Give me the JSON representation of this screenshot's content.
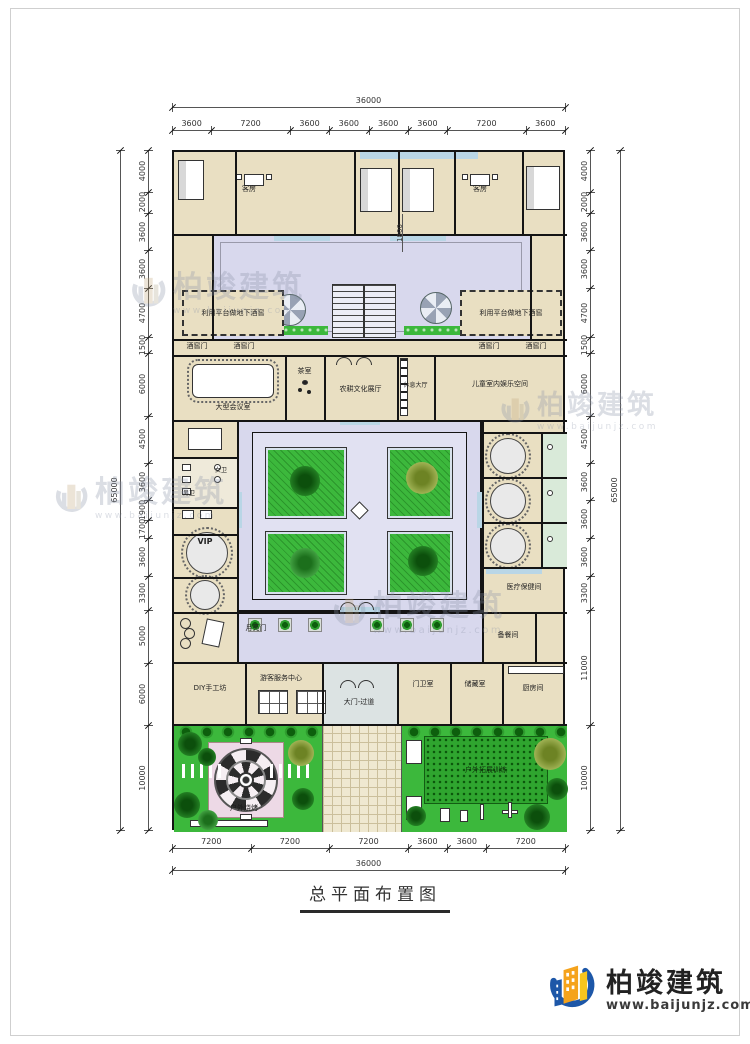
{
  "title": {
    "text": "总平面布置图"
  },
  "logo": {
    "name": "柏竣建筑",
    "url": "www.baijunjz.com"
  },
  "watermark": {
    "text": "柏竣建筑",
    "url": "www.baijunjz.com"
  },
  "colors": {
    "wall": "#141414",
    "room_fill": "#e9dfc2",
    "courtyard": "#d8d8ed",
    "courtyard_inner": "#e1e1f2",
    "green": "#3cb83c",
    "accent_blue": "#b9d6e6",
    "logo_blue": "#1d57a8",
    "logo_orange": "#f5a31c",
    "logo_yellow": "#f7c51d"
  },
  "dims": {
    "top": {
      "total": "36000",
      "segments": [
        "3600",
        "7200",
        "3600",
        "3600",
        "3600",
        "3600",
        "7200",
        "3600"
      ]
    },
    "bottom": {
      "total": "36000",
      "segments": [
        "7200",
        "7200",
        "7200",
        "3600",
        "3600",
        "7200"
      ]
    },
    "left": {
      "total": "65000",
      "segments": [
        "4000",
        "2000",
        "3600",
        "3600",
        "4700",
        "1500",
        "6000",
        "4500",
        "3600",
        "1900",
        "1700",
        "3600",
        "3300",
        "5000",
        "6000",
        "10000"
      ]
    },
    "right": {
      "total": "65000",
      "segments": [
        "4000",
        "2000",
        "3600",
        "3600",
        "4700",
        "1500",
        "6000",
        "4500",
        "3600",
        "3600",
        "3600",
        "3300",
        "11000",
        "10000"
      ]
    },
    "inner": {
      "courtyard_width": "1800"
    }
  },
  "rooms": {
    "guest": "客房",
    "cellar": "利用平台做地下酒窖",
    "cellar_door": "酒窖门",
    "conference": "大型会议室",
    "tea": "茶室",
    "exhibit": "农耕文化展厅",
    "lounge": "休息大厅",
    "kids": "儿童室内娱乐空间",
    "wc_women": "女卫",
    "wc_men": "男卫",
    "vip": "VIP",
    "medical": "医疗保健间",
    "moon_gate": "月亮门",
    "prep": "备餐间",
    "diy": "DIY手工坊",
    "visitor": "游客服务中心",
    "gate": "大门-过道",
    "guard": "门卫室",
    "storage": "储藏室",
    "kitchen": "厨房间",
    "bbq": "户外烧烤",
    "training": "户外拓展训练"
  }
}
